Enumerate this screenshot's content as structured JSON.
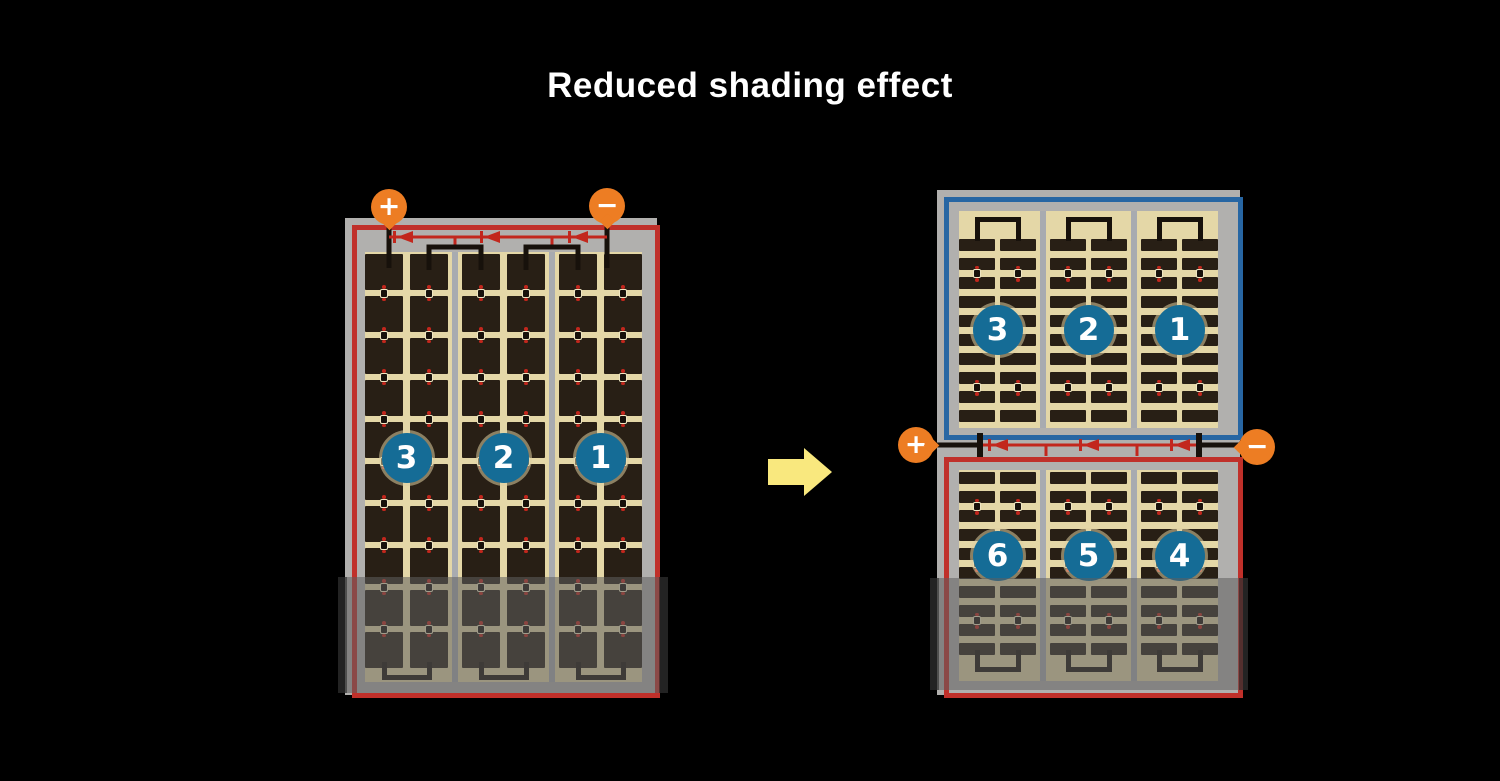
{
  "title": "Reduced shading effect",
  "colors": {
    "background": "#000000",
    "title_text": "#ffffff",
    "panel_frame_gray": "#b1b0ae",
    "cell_tan": "#e4d7a7",
    "cell_dark": "#281f15",
    "string_divider_gray": "#a8abb0",
    "series_border_red": "#c0302a",
    "parallel_border_blue": "#2766a3",
    "string_badge_blue": "#156c96",
    "terminal_orange": "#ed7d23",
    "diode_red": "#c2271d",
    "arrow_yellow": "#f9e87e",
    "wire_black": "#17110b",
    "shading_overlay": "rgba(95,95,95,0.55)"
  },
  "left_module": {
    "name": "full-cell module with bottom shading",
    "terminals": [
      {
        "polarity": "positive",
        "symbol": "+"
      },
      {
        "polarity": "negative",
        "symbol": "−"
      }
    ],
    "strings": [
      {
        "number": "3"
      },
      {
        "number": "2"
      },
      {
        "number": "1"
      }
    ],
    "rows": 10,
    "columns_per_string": 2,
    "bypass_diodes": 3,
    "shaded_region": "bottom rows"
  },
  "right_module": {
    "name": "half-cell module with bottom shading",
    "terminals": [
      {
        "polarity": "positive",
        "symbol": "+"
      },
      {
        "polarity": "negative",
        "symbol": "−"
      }
    ],
    "top_half": {
      "border": "blue",
      "strings": [
        {
          "number": "3"
        },
        {
          "number": "2"
        },
        {
          "number": "1"
        }
      ],
      "rows": 10,
      "columns_per_string": 2
    },
    "bottom_half": {
      "border": "red",
      "strings": [
        {
          "number": "6"
        },
        {
          "number": "5"
        },
        {
          "number": "4"
        }
      ],
      "rows": 10,
      "columns_per_string": 2
    },
    "bypass_diodes": 3,
    "shaded_region": "bottom rows of lower half"
  },
  "arrow": {
    "direction": "right"
  }
}
